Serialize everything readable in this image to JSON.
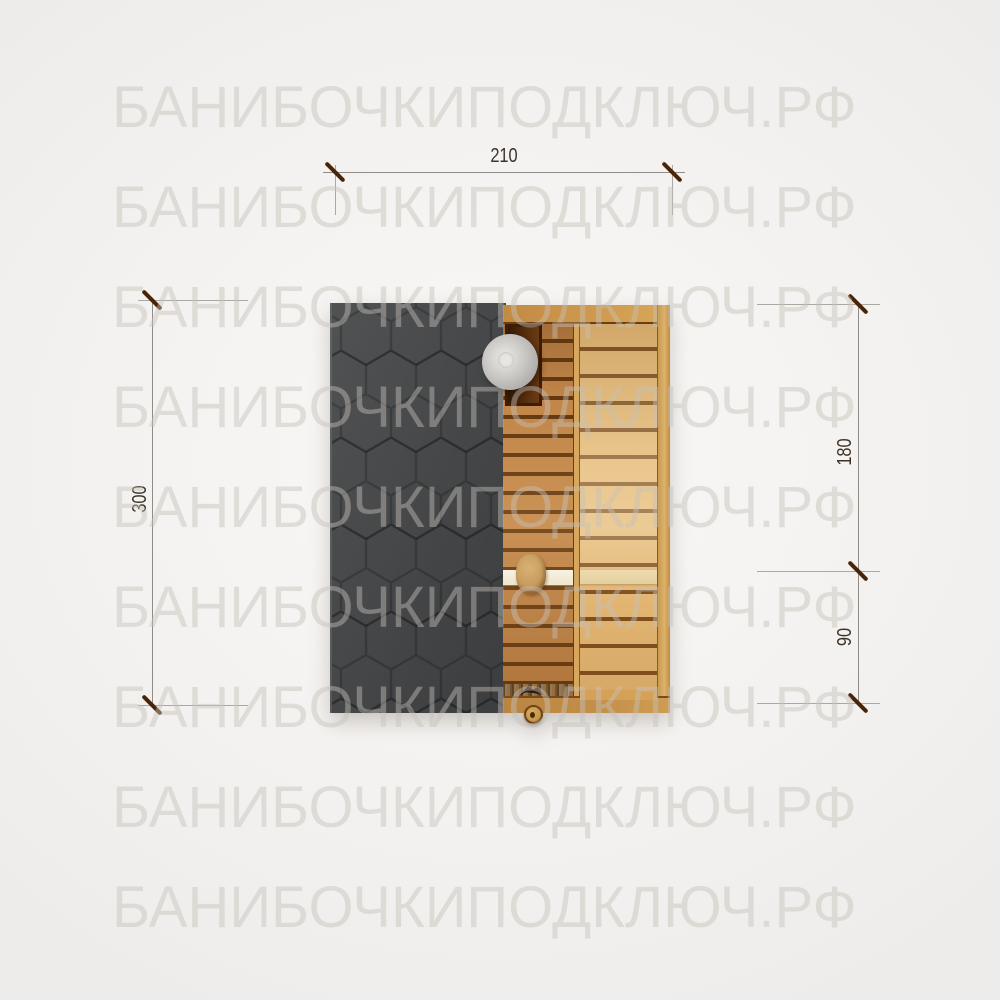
{
  "watermark": {
    "text": "БАНИБОЧКИПОДКЛЮЧ.РФ",
    "row_count": 9
  },
  "dimensions": {
    "top": {
      "label": "210"
    },
    "left": {
      "label": "300"
    },
    "right_upper": {
      "label": "180"
    },
    "right_lower": {
      "label": "90"
    }
  },
  "colors": {
    "background": "#f4f2f0",
    "watermark_text": "#d9d5d1",
    "roof_shingles": "#46484a",
    "wood_slats_mid": "#c2864a",
    "wood_slats_light": "#e2b572",
    "slat_gap_dark": "#64370f",
    "wood_rail": "#c28a43",
    "bench_white": "#f2ecd9",
    "bench_cream": "#e7d5a6",
    "stove_box": "#4a2609",
    "chimney_gray": "#c6c4c1",
    "dimension_line": "#8f8c88",
    "dimension_tick": "#4a2407",
    "dimension_text": "#3f3328"
  }
}
